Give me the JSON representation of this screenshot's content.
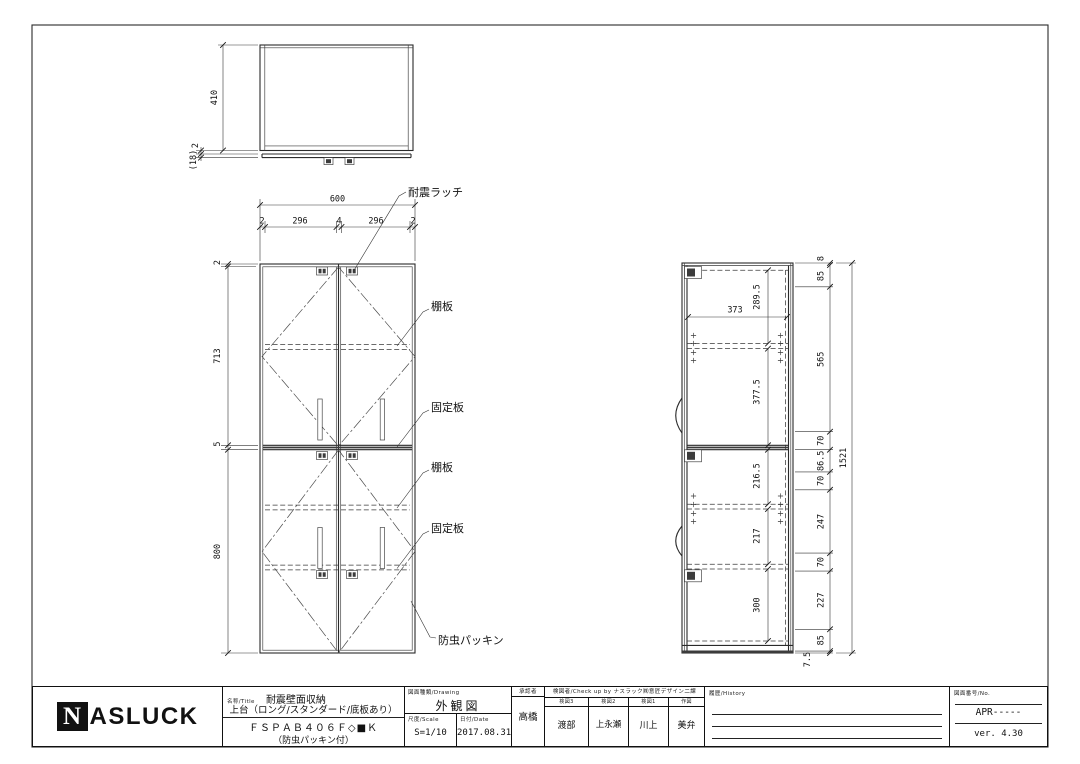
{
  "top_view": {
    "dim_depth": "410",
    "dim_top_gap": "2",
    "dim_door": "(18)"
  },
  "front_view": {
    "dim_width": "600",
    "width_segments": [
      "2",
      "296",
      "4",
      "296",
      "2"
    ],
    "height_segments": [
      "2",
      "713",
      "5",
      "800"
    ],
    "callouts": {
      "latch": "耐震ラッチ",
      "shelf_upper": "棚板",
      "fixed_upper": "固定板",
      "shelf_lower": "棚板",
      "fixed_lower": "固定板",
      "packing": "防虫パッキン"
    }
  },
  "side_view": {
    "dim_overall": "1521",
    "inner_dims": {
      "top_to_shelf": "289.5",
      "inner_width": "373",
      "shelf_to_divider": "377.5",
      "divider_to_shelf": "216.5",
      "shelf_to_fixed": "217",
      "fixed_to_bottom": "300"
    },
    "chain_dims": [
      "8",
      "85",
      "565",
      "70",
      "86.5",
      "70",
      "247",
      "70",
      "227",
      "85",
      "7.5"
    ]
  },
  "title_block": {
    "logo_n": "N",
    "logo_rest": "ASLUCK",
    "title_label": "名称/Title",
    "product_title": "耐震壁面収納",
    "product_sub": "上台（ロング/スタンダード/底板あり）",
    "model_code": "ＦＳＰＡＢ４０６Ｆ◇■Ｋ",
    "model_note": "（防虫パッキン付）",
    "drawing_label": "図面種類/Drawing",
    "drawing_name": "外観図",
    "scale_label": "尺度/Scale",
    "scale_value": "S=1/10",
    "date_label": "日付/Date",
    "date_value": "2017.08.31",
    "approved_label": "承認者",
    "approved_by": "高橋",
    "checkup_label": "検図者/Check up by ナスラック㈱意匠デザイン二課",
    "checkers": [
      {
        "role": "検図3",
        "name": "渡部"
      },
      {
        "role": "検図2",
        "name": "上永瀬"
      },
      {
        "role": "検図1",
        "name": "川上"
      },
      {
        "role": "作図",
        "name": "美弁"
      }
    ],
    "history_label": "履歴/History",
    "number_label": "図面番号/No.",
    "number_value": "APR-----",
    "version": "ver. 4.30"
  }
}
